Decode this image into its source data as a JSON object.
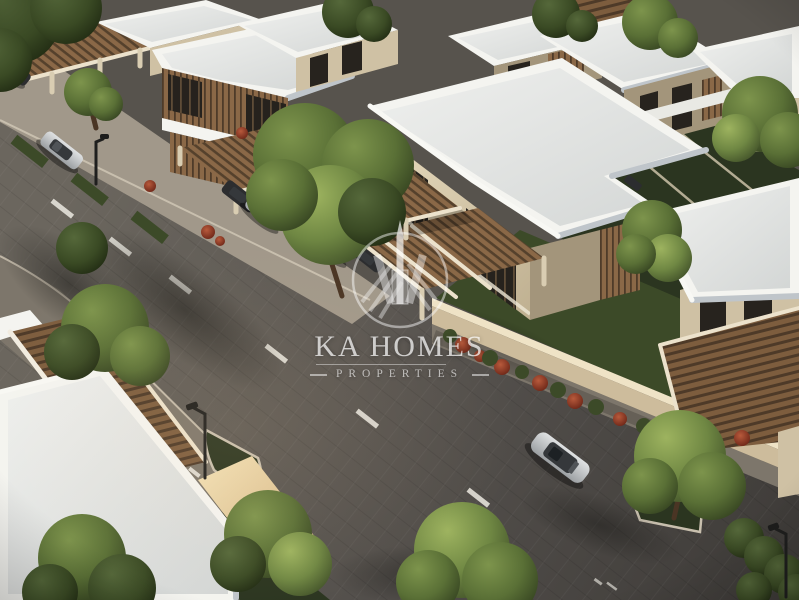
{
  "image": {
    "kind": "3d-architectural-render",
    "description": "Aerial dusk view of a modern villa community: white flat-roof two-storey villas with cream walls and wooden-slat carports, paver streets with dashed lane markings, parked and moving cars, trees, red flowering shrubs, compound walls and street lamps.",
    "objects": [
      "villa-top-left",
      "villa-main-center",
      "villas-right-row",
      "villa-bottom-left",
      "pergola-bottom-right",
      "compound-wall",
      "street-diagonal",
      "side-street-junction",
      "grass-median",
      "parked-silver-suv",
      "carport-cars",
      "blue-car",
      "moving-silver-sedan",
      "street-lamp",
      "trees",
      "red-flower-bushes"
    ]
  },
  "watermark": {
    "brand": "KA HOMES",
    "tagline": "PROPERTIES",
    "logo": "skyline-towers-in-circle emblem",
    "color": "#ffffff"
  },
  "palette": {
    "asphalt": "#57534d",
    "asphalt_dark": "#3e3b37",
    "asphalt_light": "#6e685f",
    "sidewalk": "#a1988a",
    "curb": "#cfc6b4",
    "roof_top": "#e2e2de",
    "roof_bright": "#f4f4f0",
    "roof_shade": "#bfc5ca",
    "wall_light": "#e6d9bc",
    "wall_mid": "#cfc1a4",
    "wall_dark": "#a3957b",
    "wood": "#8a6847",
    "wood_dark": "#53402c",
    "window_dark": "#27231e",
    "window_frame": "#5e4c37",
    "grass_dark": "#2b3520",
    "grass_mid": "#3c4a28",
    "tree_light": "#8ba153",
    "tree_mid": "#5f7539",
    "tree_dark": "#36451f",
    "flower_red": "#9e3e2a",
    "car_silver": "#c9cbcc",
    "car_dark": "#2c2d2f",
    "car_blue": "#2f5b79",
    "watermark_white": "#ffffff"
  }
}
